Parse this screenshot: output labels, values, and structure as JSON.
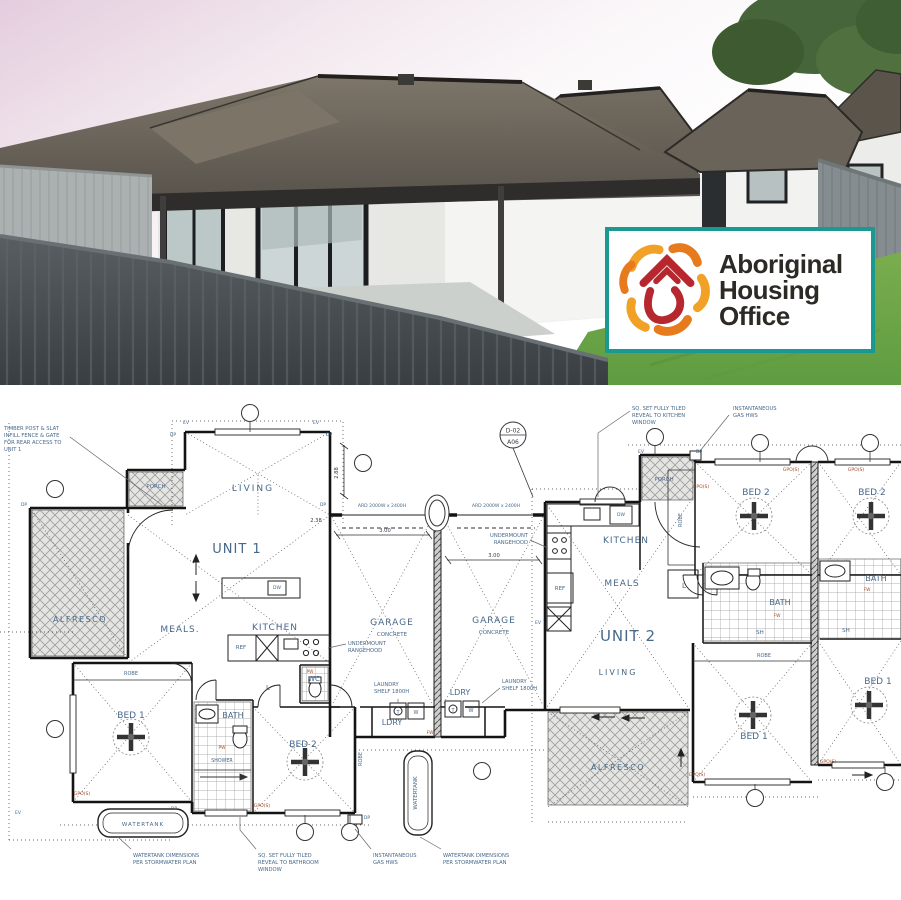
{
  "logo": {
    "org_line1": "Aboriginal",
    "org_line2": "Housing",
    "org_line3": "Office",
    "border_color": "#1a9992",
    "icon_red": "#b6282e",
    "icon_orange": "#e87a1e",
    "icon_amber": "#f0a126"
  },
  "floor_plan": {
    "label_color": "#47688a",
    "tag_color": "#a34a2a",
    "dim_color": "#3a3a4a",
    "door_tag": {
      "top": "D-02",
      "bottom": "A06"
    },
    "labels": [
      {
        "id": "unit-1",
        "t": "UNIT 1",
        "x": 237,
        "y": 168,
        "s": 13,
        "ls": 1
      },
      {
        "id": "unit-2",
        "t": "UNIT 2",
        "x": 628,
        "y": 256,
        "s": 15,
        "ls": 1
      },
      {
        "id": "living-1",
        "t": "LIVING",
        "x": 253,
        "y": 106,
        "s": 9,
        "ls": 2
      },
      {
        "id": "living-2",
        "t": "LIVING",
        "x": 618,
        "y": 290,
        "s": 8,
        "ls": 2
      },
      {
        "id": "meals-1",
        "t": "MEALS.",
        "x": 180,
        "y": 247,
        "s": 9,
        "ls": 1
      },
      {
        "id": "meals-2",
        "t": "MEALS",
        "x": 622,
        "y": 201,
        "s": 9,
        "ls": 1
      },
      {
        "id": "kitchen-1",
        "t": "KITCHEN",
        "x": 275,
        "y": 245,
        "s": 9,
        "ls": 1
      },
      {
        "id": "kitchen-2",
        "t": "KITCHEN",
        "x": 626,
        "y": 158,
        "s": 9,
        "ls": 1
      },
      {
        "id": "garage-1",
        "t": "GARAGE",
        "x": 392,
        "y": 240,
        "s": 9,
        "ls": 1
      },
      {
        "id": "concrete-1",
        "t": "CONCRETE",
        "x": 392,
        "y": 251,
        "s": 5.5
      },
      {
        "id": "garage-2",
        "t": "GARAGE",
        "x": 494,
        "y": 238,
        "s": 9,
        "ls": 1
      },
      {
        "id": "concrete-2",
        "t": "CONCRETE",
        "x": 494,
        "y": 249,
        "s": 5.5
      },
      {
        "id": "alfresco-1",
        "t": "ALFRESCO",
        "x": 80,
        "y": 237,
        "s": 8,
        "ls": 1.5
      },
      {
        "id": "alfresco-2",
        "t": "ALFRESCO",
        "x": 618,
        "y": 385,
        "s": 8,
        "ls": 1.5
      },
      {
        "id": "porch-1",
        "t": "PORCH",
        "x": 156,
        "y": 103,
        "s": 5.5
      },
      {
        "id": "porch-2",
        "t": "PORCH",
        "x": 664,
        "y": 96,
        "s": 5.5
      },
      {
        "id": "bed1-u1",
        "t": "BED 1",
        "x": 131,
        "y": 333,
        "s": 9
      },
      {
        "id": "bed2-u1",
        "t": "BED 2",
        "x": 303,
        "y": 362,
        "s": 9
      },
      {
        "id": "bed1-u2",
        "t": "BED 1",
        "x": 754,
        "y": 354,
        "s": 9
      },
      {
        "id": "bed2-u2",
        "t": "BED 2",
        "x": 756,
        "y": 110,
        "s": 9
      },
      {
        "id": "bed1-u3",
        "t": "BED 1",
        "x": 878,
        "y": 299,
        "s": 9
      },
      {
        "id": "bed2-u3",
        "t": "BED 2",
        "x": 872,
        "y": 110,
        "s": 9
      },
      {
        "id": "bath-1",
        "t": "BATH",
        "x": 233,
        "y": 333,
        "s": 8
      },
      {
        "id": "bath-2",
        "t": "BATH",
        "x": 780,
        "y": 220,
        "s": 8
      },
      {
        "id": "bath-3",
        "t": "BATH",
        "x": 876,
        "y": 196,
        "s": 8
      },
      {
        "id": "shower-1",
        "t": "SHOWER",
        "x": 222,
        "y": 377,
        "s": 4.8
      },
      {
        "id": "sh-2",
        "t": "SH",
        "x": 760,
        "y": 249,
        "s": 5.5
      },
      {
        "id": "sh-3",
        "t": "SH",
        "x": 846,
        "y": 247,
        "s": 5.5
      },
      {
        "id": "wc-1",
        "t": "WC",
        "x": 314,
        "y": 296,
        "s": 7
      },
      {
        "id": "ldry-1",
        "t": "LDRY",
        "x": 392,
        "y": 340,
        "s": 8
      },
      {
        "id": "ldry-2",
        "t": "LDRY",
        "x": 460,
        "y": 310,
        "s": 8
      },
      {
        "id": "watertank-1",
        "t": "WATERTANK",
        "x": 143,
        "y": 441,
        "s": 5.5,
        "ls": 1
      },
      {
        "id": "watertank-2",
        "t": "WATERTANK",
        "x": 417,
        "y": 408,
        "s": 5.5,
        "rot": -90
      },
      {
        "id": "robe-1",
        "t": "ROBE",
        "x": 131,
        "y": 290,
        "s": 5
      },
      {
        "id": "robe-2",
        "t": "ROBE",
        "x": 362,
        "y": 374,
        "s": 5,
        "rot": -90
      },
      {
        "id": "robe-3",
        "t": "ROBE",
        "x": 682,
        "y": 135,
        "s": 5,
        "rot": -90
      },
      {
        "id": "robe-4",
        "t": "ROBE",
        "x": 764,
        "y": 272,
        "s": 5
      },
      {
        "id": "ref-1",
        "t": "REF",
        "x": 241,
        "y": 264,
        "s": 5.5
      },
      {
        "id": "ref-2",
        "t": "REF",
        "x": 560,
        "y": 205,
        "s": 5.5
      },
      {
        "id": "dw-1",
        "t": "DW",
        "x": 277,
        "y": 204,
        "s": 4.5
      },
      {
        "id": "dw-2",
        "t": "DW",
        "x": 621,
        "y": 131,
        "s": 4.5
      },
      {
        "id": "linen-1",
        "t": "L",
        "x": 268,
        "y": 305,
        "s": 7
      },
      {
        "id": "linen-2",
        "t": "L",
        "x": 684,
        "y": 203,
        "s": 7
      },
      {
        "id": "trough-1",
        "t": "T",
        "x": 398,
        "y": 329,
        "s": 5
      },
      {
        "id": "washer-1",
        "t": "W",
        "x": 416,
        "y": 329,
        "s": 5
      },
      {
        "id": "trough-2",
        "t": "T",
        "x": 453,
        "y": 327,
        "s": 5
      },
      {
        "id": "washer-2",
        "t": "W",
        "x": 471,
        "y": 327,
        "s": 5
      },
      {
        "id": "ard-1",
        "t": "ARD 2000W x 2400H",
        "x": 382,
        "y": 122,
        "s": 4.6
      },
      {
        "id": "ard-2",
        "t": "ARD 2000W x 2400H",
        "x": 496,
        "y": 122,
        "s": 4.6
      },
      {
        "id": "dim-1",
        "t": "3.00",
        "x": 385,
        "y": 147,
        "s": 5.2,
        "c": "#3a3a4a"
      },
      {
        "id": "dim-2",
        "t": "3.00",
        "x": 494,
        "y": 172,
        "s": 5.2,
        "c": "#3a3a4a"
      },
      {
        "id": "dim-3",
        "t": "2.88",
        "x": 338,
        "y": 88,
        "s": 5.2,
        "c": "#3a3a4a",
        "rot": -90
      },
      {
        "id": "dim-4",
        "t": "2.38",
        "x": 316,
        "y": 137,
        "s": 5.2,
        "c": "#3a3a4a"
      },
      {
        "id": "gpo-1",
        "t": "GPO(S)",
        "x": 82,
        "y": 410,
        "s": 4.6,
        "c": "#a34a2a"
      },
      {
        "id": "gpo-2",
        "t": "GPO(S)",
        "x": 262,
        "y": 422,
        "s": 4.6,
        "c": "#a34a2a"
      },
      {
        "id": "gpo-3",
        "t": "GPO(S)",
        "x": 701,
        "y": 103,
        "s": 4.6,
        "c": "#a34a2a"
      },
      {
        "id": "gpo-4",
        "t": "GPO(S)",
        "x": 791,
        "y": 86,
        "s": 4.6,
        "c": "#a34a2a"
      },
      {
        "id": "gpo-5",
        "t": "GPO(S)",
        "x": 856,
        "y": 86,
        "s": 4.6,
        "c": "#a34a2a"
      },
      {
        "id": "gpo-6",
        "t": "GPO(S)",
        "x": 697,
        "y": 391,
        "s": 4.6,
        "c": "#a34a2a"
      },
      {
        "id": "gpo-7",
        "t": "GPO(S)",
        "x": 828,
        "y": 378,
        "s": 4.6,
        "c": "#a34a2a"
      },
      {
        "id": "ev-1",
        "t": "EV",
        "x": 186,
        "y": 39,
        "s": 4.6
      },
      {
        "id": "dp-1",
        "t": "DP",
        "x": 173,
        "y": 51,
        "s": 4.6
      },
      {
        "id": "ev-2",
        "t": "EV",
        "x": 316,
        "y": 39,
        "s": 4.6
      },
      {
        "id": "dp-2",
        "t": "DP",
        "x": 329,
        "y": 51,
        "s": 4.6
      },
      {
        "id": "dp-3",
        "t": "DP",
        "x": 24,
        "y": 121,
        "s": 4.6
      },
      {
        "id": "ev-3",
        "t": "EV",
        "x": 641,
        "y": 68,
        "s": 4.6
      },
      {
        "id": "dp-4",
        "t": "DP",
        "x": 699,
        "y": 68,
        "s": 4.6
      },
      {
        "id": "dp-5",
        "t": "DP",
        "x": 323,
        "y": 121,
        "s": 4.6
      },
      {
        "id": "ev-4",
        "t": "EV",
        "x": 538,
        "y": 239,
        "s": 4.6
      },
      {
        "id": "dp-6",
        "t": "DP",
        "x": 367,
        "y": 434,
        "s": 4.6
      },
      {
        "id": "ev-5",
        "t": "EV",
        "x": 18,
        "y": 429,
        "s": 4.6
      },
      {
        "id": "dp-7",
        "t": "DP",
        "x": 174,
        "y": 425,
        "s": 4.6
      },
      {
        "id": "pw-1",
        "t": "PW",
        "x": 222,
        "y": 364,
        "s": 4.4,
        "c": "#a34a2a"
      },
      {
        "id": "pw-2",
        "t": "PW",
        "x": 310,
        "y": 288,
        "s": 4.4,
        "c": "#a34a2a"
      },
      {
        "id": "fw-1",
        "t": "FW",
        "x": 430,
        "y": 349,
        "s": 4.4,
        "c": "#a34a2a"
      },
      {
        "id": "fw-2",
        "t": "FW",
        "x": 777,
        "y": 232,
        "s": 4.4,
        "c": "#a34a2a"
      },
      {
        "id": "fw-3",
        "t": "FW",
        "x": 867,
        "y": 206,
        "s": 4.4,
        "c": "#a34a2a"
      }
    ],
    "notes": [
      {
        "id": "fence-note",
        "x": 4,
        "y": 45,
        "lines": [
          "TIMBER POST & SLAT",
          "INFILL FENCE & GATE",
          "FOR REAR ACCESS TO",
          "UNIT 1"
        ]
      },
      {
        "id": "kitchen-window-note",
        "x": 632,
        "y": 25,
        "lines": [
          "SQ. SET FULLY TILED",
          "REVEAL TO KITCHEN",
          "WINDOW"
        ]
      },
      {
        "id": "gas-hws-top-note",
        "x": 733,
        "y": 25,
        "lines": [
          "INSTANTANEOUS",
          "GAS HWS"
        ]
      },
      {
        "id": "watertank-note-1",
        "x": 133,
        "y": 472,
        "lines": [
          "WATERTANK DIMENSIONS",
          "PER STORMWATER PLAN"
        ]
      },
      {
        "id": "bathroom-window-note",
        "x": 258,
        "y": 472,
        "lines": [
          "SQ. SET FULLY TILED",
          "REVEAL TO BATHROOM",
          "WINDOW"
        ]
      },
      {
        "id": "gas-hws-bottom-note",
        "x": 373,
        "y": 472,
        "lines": [
          "INSTANTANEOUS",
          "GAS HWS"
        ]
      },
      {
        "id": "watertank-note-2",
        "x": 443,
        "y": 472,
        "lines": [
          "WATERTANK DIMENSIONS",
          "PER STORMWATER PLAN"
        ]
      },
      {
        "id": "rangehood-note-1",
        "x": 348,
        "y": 260,
        "lines": [
          "UNDERMOUNT",
          "RANGEHOOD"
        ]
      },
      {
        "id": "rangehood-note-2",
        "x": 528,
        "y": 152,
        "a": "end",
        "lines": [
          "UNDERMOUNT",
          "RANGEHOOD"
        ]
      },
      {
        "id": "laundry-shelf-note-1",
        "x": 374,
        "y": 301,
        "lines": [
          "LAUNDRY",
          "SHELF 1800H"
        ]
      },
      {
        "id": "laundry-shelf-note-2",
        "x": 502,
        "y": 298,
        "lines": [
          "LAUNDRY",
          "SHELF 1800H"
        ]
      }
    ]
  }
}
